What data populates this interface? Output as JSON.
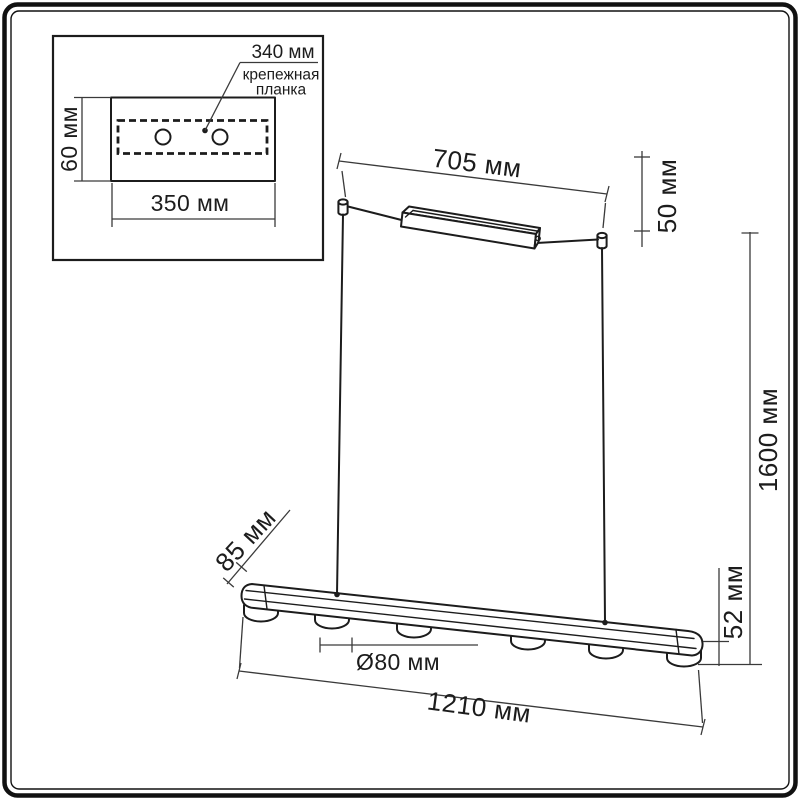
{
  "units": "мм",
  "colors": {
    "line": "#1c1c1c",
    "dimension_line": "#3a3a3a",
    "background": "#ffffff"
  },
  "inset": {
    "bracket_width": "340 мм",
    "bracket_label_line1": "крепежная",
    "bracket_label_line2": "планка",
    "plate_height": "60 мм",
    "plate_width": "350 мм",
    "hole_count": 2
  },
  "dims": {
    "canopy_length": "705 мм",
    "canopy_height": "50 мм",
    "suspension": "1600 мм",
    "fixture_end_height": "52 мм",
    "fixture_depth": "85 мм",
    "spot_diameter": "Ø80 мм",
    "fixture_length": "1210 мм"
  },
  "figure": {
    "spot_count": 6,
    "cable_count": 2
  }
}
